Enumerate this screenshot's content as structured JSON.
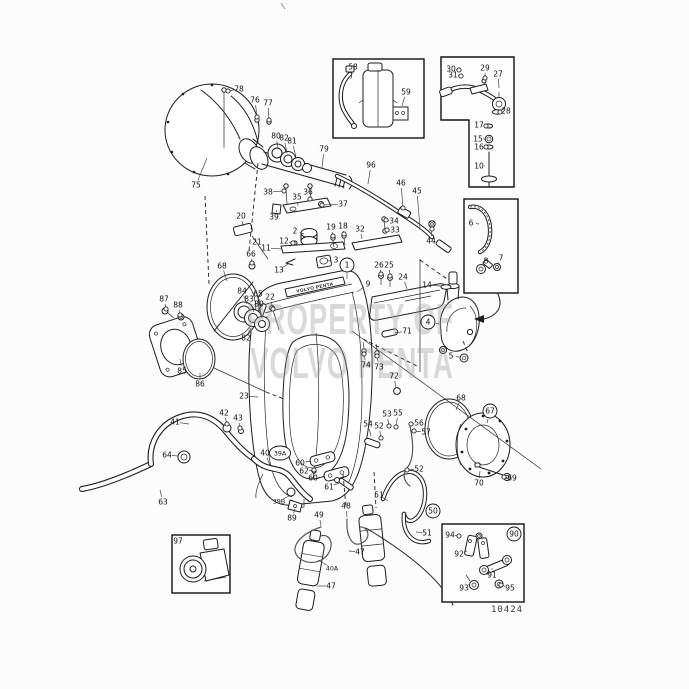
{
  "watermark": {
    "line1": "PROPERTY OF",
    "line2": "VOLVO PENTA"
  },
  "footer": {
    "drawing_number": "10424"
  },
  "housing": {
    "nameplate": "VOLVO PENTA"
  },
  "parts": [
    {
      "n": "78",
      "x": 239,
      "y": 89,
      "lx": 228,
      "ly": 91,
      "d": 1
    },
    {
      "n": "76",
      "x": 255,
      "y": 100,
      "lx": 257,
      "ly": 117,
      "d": 1
    },
    {
      "n": "77",
      "x": 268,
      "y": 103,
      "lx": 269,
      "ly": 120,
      "d": 1
    },
    {
      "n": "75",
      "x": 196,
      "y": 185,
      "lx": 207,
      "ly": 158
    },
    {
      "n": "80",
      "x": 276,
      "y": 136,
      "lx": 278,
      "ly": 148
    },
    {
      "n": "82",
      "x": 284,
      "y": 138,
      "lx": 287,
      "ly": 153
    },
    {
      "n": "81",
      "x": 292,
      "y": 141,
      "lx": 296,
      "ly": 157
    },
    {
      "n": "79",
      "x": 324,
      "y": 149,
      "lx": 322,
      "ly": 168
    },
    {
      "n": "96",
      "x": 371,
      "y": 165,
      "lx": 368,
      "ly": 184
    },
    {
      "n": "46",
      "x": 401,
      "y": 183,
      "lx": 403,
      "ly": 208,
      "d": 1
    },
    {
      "n": "45",
      "x": 417,
      "y": 191,
      "lx": 420,
      "ly": 228
    },
    {
      "n": "44",
      "x": 431,
      "y": 241,
      "lx": 432,
      "ly": 229,
      "d": 1
    },
    {
      "n": "38",
      "x": 268,
      "y": 192,
      "lx": 284,
      "ly": 191,
      "d": 1
    },
    {
      "n": "35",
      "x": 297,
      "y": 197,
      "lx": 298,
      "ly": 206
    },
    {
      "n": "36",
      "x": 308,
      "y": 192,
      "lx": 310,
      "ly": 199,
      "d": 1
    },
    {
      "n": "37",
      "x": 343,
      "y": 204,
      "lx": 322,
      "ly": 205,
      "d": 1
    },
    {
      "n": "39",
      "x": 274,
      "y": 217,
      "lx": 277,
      "ly": 210
    },
    {
      "n": "20",
      "x": 241,
      "y": 216,
      "lx": 243,
      "ly": 226
    },
    {
      "n": "21",
      "x": 257,
      "y": 242,
      "lx": 263,
      "ly": 252
    },
    {
      "n": "2",
      "x": 295,
      "y": 231,
      "lx": 304,
      "ly": 234
    },
    {
      "n": "12",
      "x": 284,
      "y": 241,
      "lx": 293,
      "ly": 243,
      "d": 1
    },
    {
      "n": "11",
      "x": 266,
      "y": 248,
      "lx": 282,
      "ly": 249
    },
    {
      "n": "13",
      "x": 279,
      "y": 270,
      "lx": 288,
      "ly": 264
    },
    {
      "n": "3",
      "x": 336,
      "y": 260,
      "lx": 327,
      "ly": 261
    },
    {
      "n": "19",
      "x": 331,
      "y": 227,
      "lx": 333,
      "ly": 236,
      "d": 1
    },
    {
      "n": "18",
      "x": 343,
      "y": 226,
      "lx": 344,
      "ly": 234,
      "d": 1
    },
    {
      "n": "32",
      "x": 360,
      "y": 229,
      "lx": 362,
      "ly": 239
    },
    {
      "n": "34",
      "x": 394,
      "y": 221,
      "lx": 386,
      "ly": 220,
      "d": 1
    },
    {
      "n": "33",
      "x": 395,
      "y": 230,
      "lx": 387,
      "ly": 230,
      "d": 1
    },
    {
      "n": "26",
      "x": 379,
      "y": 265,
      "lx": 381,
      "ly": 274,
      "d": 1
    },
    {
      "n": "25",
      "x": 389,
      "y": 265,
      "lx": 390,
      "ly": 276,
      "d": 1
    },
    {
      "n": "24",
      "x": 403,
      "y": 277,
      "lx": 407,
      "ly": 289
    },
    {
      "n": "9",
      "x": 368,
      "y": 284,
      "lx": 357,
      "ly": 292
    },
    {
      "n": "1",
      "x": 347,
      "y": 265,
      "circled": 1,
      "lx": 347,
      "ly": 279
    },
    {
      "n": "71",
      "x": 407,
      "y": 331,
      "lx": 395,
      "ly": 333
    },
    {
      "n": "14",
      "x": 427,
      "y": 285,
      "lx": 441,
      "ly": 286
    },
    {
      "n": "4",
      "x": 428,
      "y": 322,
      "circled": 1,
      "lx": 439,
      "ly": 324
    },
    {
      "n": "5",
      "x": 451,
      "y": 356,
      "lx": 459,
      "ly": 357
    },
    {
      "n": "72",
      "x": 394,
      "y": 376,
      "lx": 396,
      "ly": 388
    },
    {
      "n": "73",
      "x": 379,
      "y": 367,
      "lx": 377,
      "ly": 356,
      "d": 1
    },
    {
      "n": "74",
      "x": 366,
      "y": 365,
      "lx": 364,
      "ly": 354,
      "d": 1
    },
    {
      "n": "23",
      "x": 244,
      "y": 396,
      "lx": 258,
      "ly": 397
    },
    {
      "n": "22",
      "x": 270,
      "y": 297,
      "lx": 273,
      "ly": 309,
      "d": 1
    },
    {
      "n": "65",
      "x": 258,
      "y": 294,
      "lx": 261,
      "ly": 306
    },
    {
      "n": "66",
      "x": 251,
      "y": 254,
      "lx": 252,
      "ly": 263,
      "d": 1
    },
    {
      "n": "68",
      "x": 222,
      "y": 266,
      "lx": 227,
      "ly": 281
    },
    {
      "n": "84",
      "x": 242,
      "y": 291,
      "lx": 247,
      "ly": 304
    },
    {
      "n": "83",
      "x": 249,
      "y": 299,
      "lx": 254,
      "ly": 312
    },
    {
      "n": "80",
      "x": 259,
      "y": 304,
      "lx": 262,
      "ly": 318
    },
    {
      "n": "82",
      "x": 246,
      "y": 338,
      "lx": 251,
      "ly": 328
    },
    {
      "n": "87",
      "x": 164,
      "y": 299,
      "lx": 166,
      "ly": 309,
      "d": 1
    },
    {
      "n": "88",
      "x": 178,
      "y": 305,
      "lx": 180,
      "ly": 315,
      "d": 1
    },
    {
      "n": "85",
      "x": 182,
      "y": 371,
      "lx": 180,
      "ly": 359
    },
    {
      "n": "86",
      "x": 200,
      "y": 384,
      "lx": 200,
      "ly": 373
    },
    {
      "n": "41",
      "x": 175,
      "y": 422,
      "lx": 189,
      "ly": 424
    },
    {
      "n": "42",
      "x": 224,
      "y": 413,
      "lx": 227,
      "ly": 424,
      "d": 1
    },
    {
      "n": "43",
      "x": 238,
      "y": 418,
      "lx": 240,
      "ly": 428,
      "d": 1
    },
    {
      "n": "64",
      "x": 167,
      "y": 455,
      "lx": 178,
      "ly": 456
    },
    {
      "n": "63",
      "x": 163,
      "y": 502,
      "lx": 160,
      "ly": 490
    },
    {
      "n": "40",
      "x": 265,
      "y": 453,
      "lx": 270,
      "ly": 465
    },
    {
      "n": "39A",
      "x": 280,
      "y": 453,
      "circled": "ellipse"
    },
    {
      "n": "60",
      "x": 300,
      "y": 463,
      "lx": 311,
      "ly": 461
    },
    {
      "n": "62",
      "x": 304,
      "y": 471,
      "lx": 314,
      "ly": 470,
      "d": 1
    },
    {
      "n": "60",
      "x": 313,
      "y": 478,
      "lx": 324,
      "ly": 477
    },
    {
      "n": "61",
      "x": 329,
      "y": 487,
      "lx": 339,
      "ly": 483
    },
    {
      "n": "39B",
      "x": 279,
      "y": 501,
      "lx": 289,
      "ly": 496
    },
    {
      "n": "89",
      "x": 292,
      "y": 518,
      "lx": 295,
      "ly": 509
    },
    {
      "n": "49",
      "x": 319,
      "y": 515,
      "lx": 321,
      "ly": 526
    },
    {
      "n": "48",
      "x": 346,
      "y": 506,
      "lx": 347,
      "ly": 517
    },
    {
      "n": "51",
      "x": 379,
      "y": 495,
      "lx": 388,
      "ly": 501
    },
    {
      "n": "50",
      "x": 433,
      "y": 511,
      "circled": 1
    },
    {
      "n": "51",
      "x": 427,
      "y": 533,
      "lx": 416,
      "ly": 532
    },
    {
      "n": "47",
      "x": 360,
      "y": 552,
      "lx": 349,
      "ly": 551
    },
    {
      "n": "40A",
      "x": 332,
      "y": 568,
      "lx": 318,
      "ly": 560
    },
    {
      "n": "47",
      "x": 331,
      "y": 586,
      "lx": 317,
      "ly": 586
    },
    {
      "n": "54",
      "x": 368,
      "y": 424,
      "lx": 371,
      "ly": 436
    },
    {
      "n": "52",
      "x": 379,
      "y": 426,
      "lx": 381,
      "ly": 438,
      "d": 1
    },
    {
      "n": "53",
      "x": 387,
      "y": 414,
      "lx": 389,
      "ly": 426,
      "d": 1
    },
    {
      "n": "55",
      "x": 398,
      "y": 413,
      "lx": 396,
      "ly": 427,
      "d": 1
    },
    {
      "n": "56",
      "x": 419,
      "y": 423,
      "lx": 411,
      "ly": 424,
      "d": 1
    },
    {
      "n": "57",
      "x": 426,
      "y": 432,
      "lx": 414,
      "ly": 431,
      "d": 1
    },
    {
      "n": "52",
      "x": 419,
      "y": 469,
      "lx": 407,
      "ly": 470,
      "d": 1
    },
    {
      "n": "68",
      "x": 461,
      "y": 398,
      "lx": 456,
      "ly": 410
    },
    {
      "n": "67",
      "x": 490,
      "y": 411,
      "circled": 1,
      "lx": 487,
      "ly": 423
    },
    {
      "n": "70",
      "x": 479,
      "y": 483,
      "lx": 480,
      "ly": 471
    },
    {
      "n": "69",
      "x": 512,
      "y": 478,
      "lx": 504,
      "ly": 477,
      "d": 1
    },
    {
      "n": "58",
      "x": 353,
      "y": 67,
      "lx": 351,
      "ly": 79
    },
    {
      "n": "59",
      "x": 406,
      "y": 92,
      "lx": 402,
      "ly": 106
    },
    {
      "n": "30",
      "x": 451,
      "y": 69,
      "lx": 459,
      "ly": 70,
      "d": 1
    },
    {
      "n": "31",
      "x": 453,
      "y": 75,
      "lx": 461,
      "ly": 76,
      "d": 1
    },
    {
      "n": "29",
      "x": 485,
      "y": 68,
      "lx": 485,
      "ly": 78,
      "d": 1
    },
    {
      "n": "27",
      "x": 498,
      "y": 74,
      "lx": 499,
      "ly": 88
    },
    {
      "n": "28",
      "x": 506,
      "y": 111,
      "lx": 500,
      "ly": 112,
      "d": 1
    },
    {
      "n": "17",
      "x": 479,
      "y": 125,
      "lx": 486,
      "ly": 126,
      "d": 1
    },
    {
      "n": "15",
      "x": 478,
      "y": 139,
      "lx": 485,
      "ly": 139
    },
    {
      "n": "16",
      "x": 479,
      "y": 147,
      "lx": 486,
      "ly": 147,
      "d": 1
    },
    {
      "n": "10",
      "x": 479,
      "y": 166,
      "lx": 485,
      "ly": 166
    },
    {
      "n": "6",
      "x": 471,
      "y": 223,
      "lx": 479,
      "ly": 224
    },
    {
      "n": "8",
      "x": 486,
      "y": 261,
      "lx": 483,
      "ly": 266
    },
    {
      "n": "7",
      "x": 501,
      "y": 258,
      "lx": 498,
      "ly": 264
    },
    {
      "n": "97",
      "x": 178,
      "y": 541
    },
    {
      "n": "94",
      "x": 450,
      "y": 535,
      "lx": 459,
      "ly": 536,
      "d": 1
    },
    {
      "n": "92",
      "x": 459,
      "y": 554,
      "lx": 467,
      "ly": 551
    },
    {
      "n": "93",
      "x": 464,
      "y": 588,
      "lx": 470,
      "ly": 584
    },
    {
      "n": "91",
      "x": 492,
      "y": 575,
      "lx": 492,
      "ly": 568
    },
    {
      "n": "95",
      "x": 510,
      "y": 588,
      "lx": 501,
      "ly": 585,
      "d": 1
    },
    {
      "n": "90",
      "x": 514,
      "y": 534,
      "circled": 1
    }
  ]
}
